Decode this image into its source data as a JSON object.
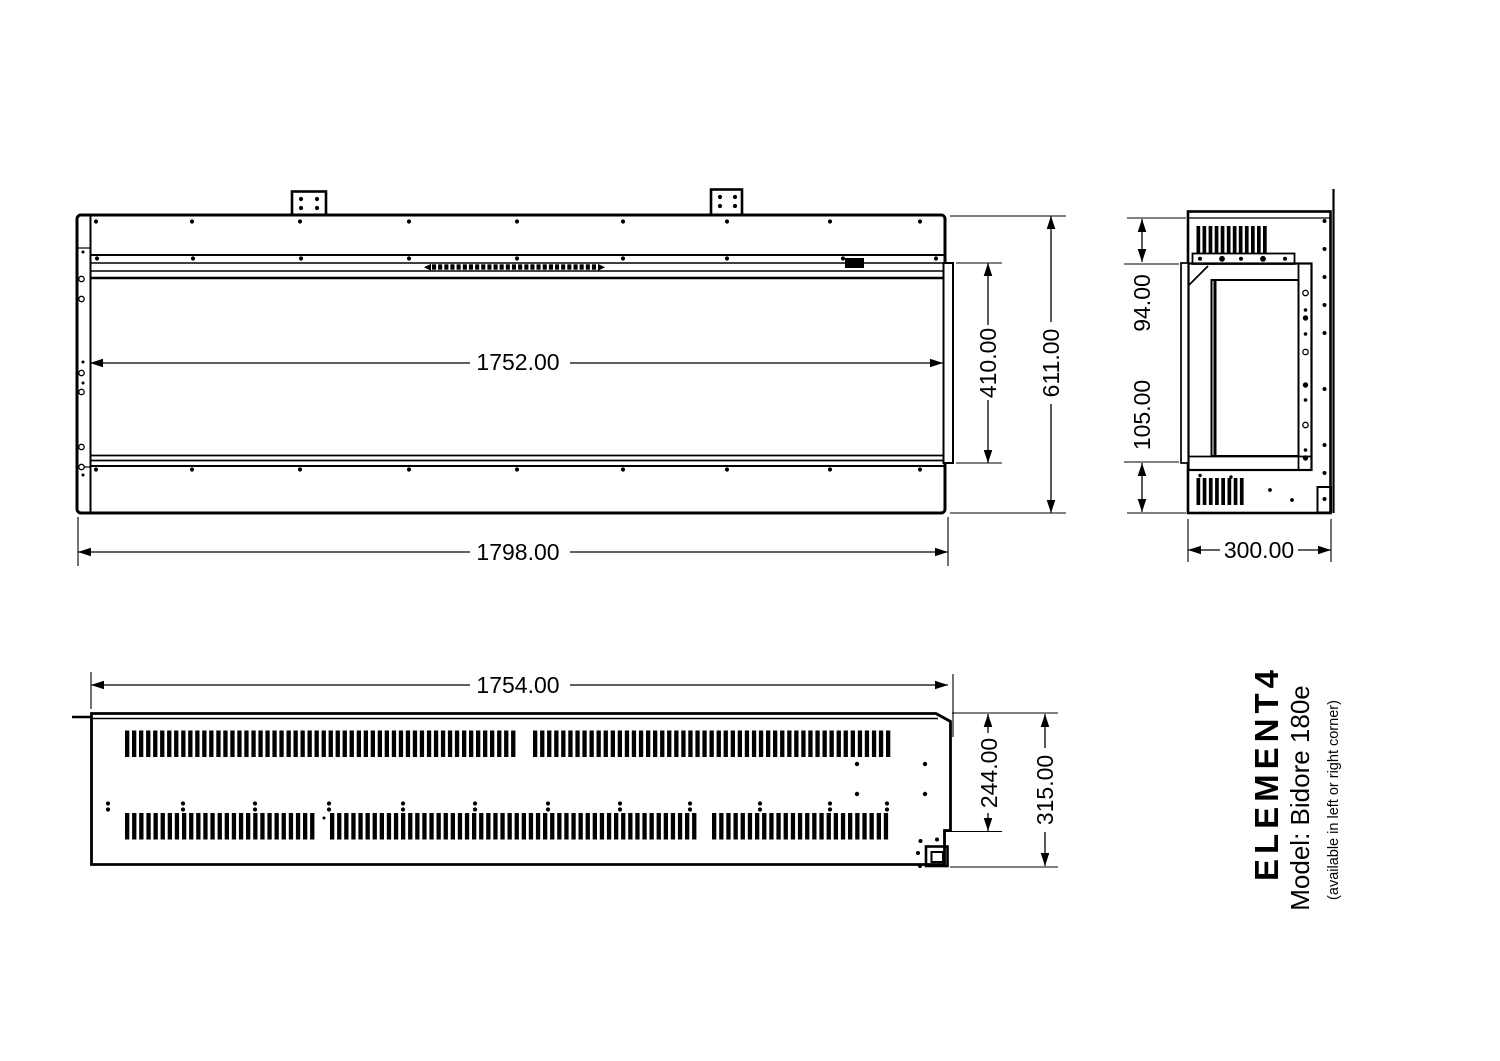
{
  "drawing": {
    "front_view": {
      "inner_width": "1752.00",
      "outer_width": "1798.00",
      "inner_height": "410.00",
      "outer_height": "611.00"
    },
    "side_view": {
      "top_inset": "94.00",
      "bottom_inset": "105.00",
      "depth": "300.00"
    },
    "plan_view": {
      "width": "1754.00",
      "inner_depth": "244.00",
      "outer_depth": "315.00"
    },
    "title_block": {
      "brand": "ELEMENT4",
      "model": "Model: Bidore 180e",
      "note": "(available in left or right corner)"
    },
    "colors": {
      "line": "#000000",
      "background": "#ffffff"
    }
  }
}
